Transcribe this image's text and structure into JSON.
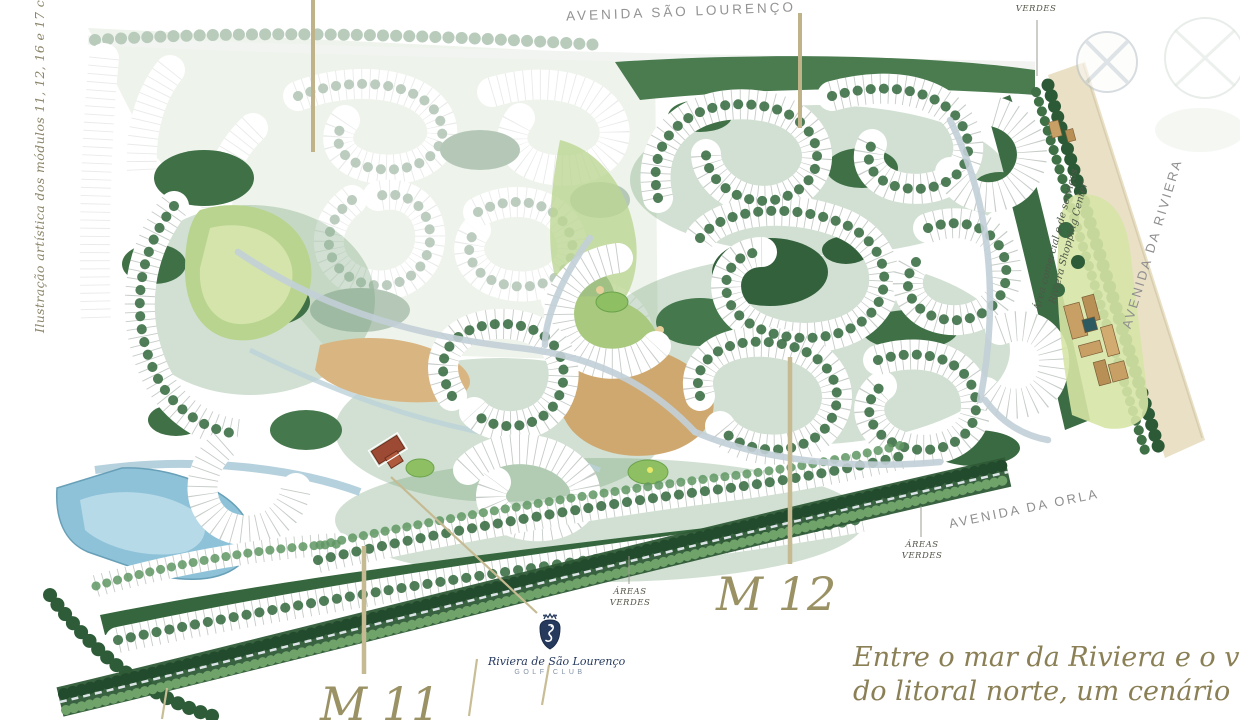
{
  "map": {
    "roads": {
      "sao_lourenco": "AVENIDA SÃO LOURENÇO",
      "riviera": "AVENIDA DA RIVIERA",
      "orla": "AVENIDA DA ORLA"
    },
    "caption_vertical": "Ilustração artística dos módulos 11, 12, 16 e 17 com o campo de golf",
    "green_area_label": {
      "line1": "ÁREAS",
      "line2": "VERDES"
    },
    "shopping": {
      "line1": "Área comercial e de serviços",
      "line2": "Riviera Shopping Center"
    },
    "modules": {
      "m11": "M 11",
      "m12": "M 12"
    },
    "golf_club": {
      "name": "Riviera de São Lourenço",
      "type": "GOLF CLUB"
    },
    "tagline": {
      "line1": "Entre o mar da Riviera e o verde",
      "line2": "do litoral norte, um cenário único."
    },
    "colors": {
      "module_label": "#9a9164",
      "road_label": "#8f8f8f",
      "tagline": "#8a7f55",
      "club_navy": "#263a5e",
      "leader_line": "#c6ba92",
      "forest_green": "#3f7046",
      "lake_blue": "#8ec2d8",
      "avenue_beige": "#e9e0c6"
    }
  }
}
